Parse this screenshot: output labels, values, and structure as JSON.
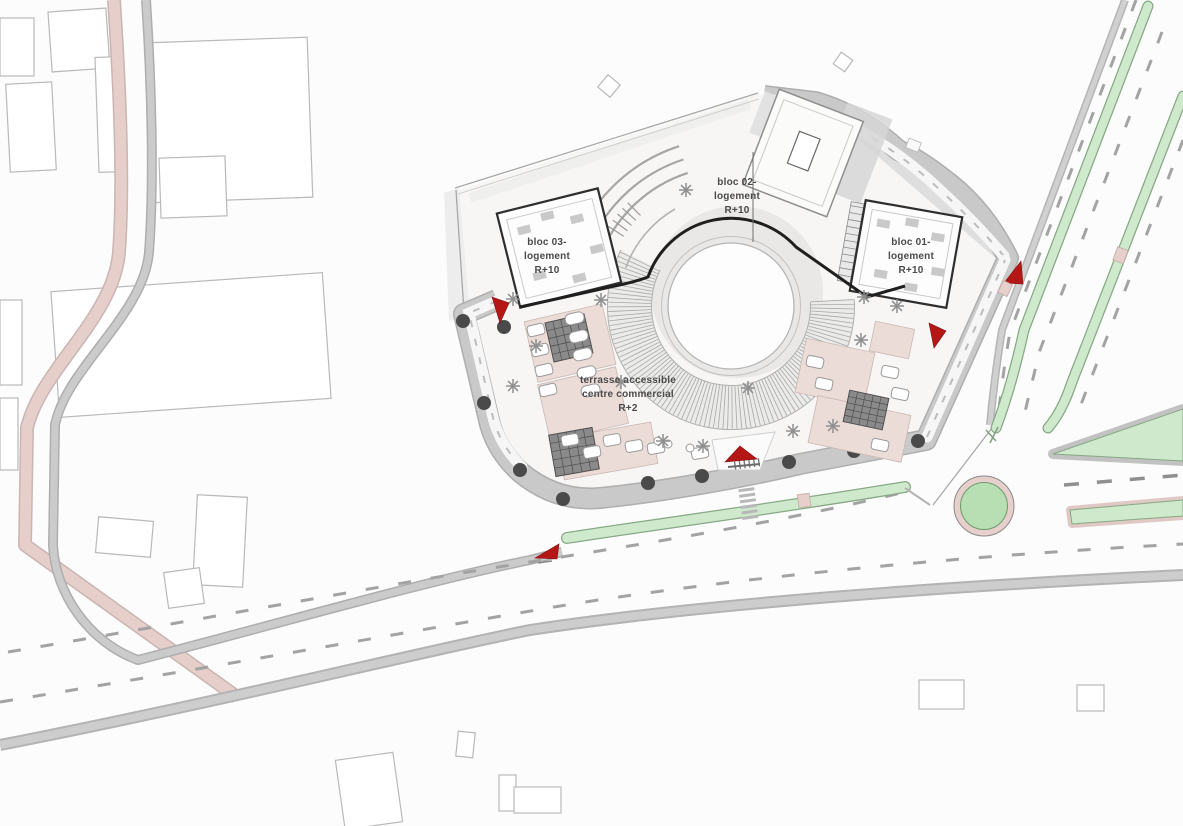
{
  "labels": {
    "bloc_03": [
      "bloc 03-",
      "logement",
      "R+10"
    ],
    "bloc_02": [
      "bloc 02-",
      "logement",
      "R+10"
    ],
    "bloc_01": [
      "bloc 01-",
      "logement",
      "R+10"
    ],
    "terrace": [
      "terrasse accessible",
      "centre commercial",
      "R+2"
    ]
  },
  "colors": {
    "background": "#fcfcfc",
    "context_building_stroke": "#b9b9b9",
    "road_band": "#c9c9c9",
    "road_band_edge": "#aeaeae",
    "road_casing": "#b5b5b5",
    "lane_dash": "#a3a3a3",
    "pink_path": "#e6cecb",
    "pink_path_edge": "#c9b5b2",
    "green_median": "#cfe9cd",
    "green_edge": "#86a884",
    "roundabout_ring": "#e7cfcb",
    "roundabout_green": "#b7dfb3",
    "terrace_pink": "#ecdcd8",
    "terrace_pink_edge": "#c9b7b3",
    "plot_fill": "#f7f6f5",
    "plaza_gray": "#e9e8e6",
    "annulus_fill": "#ebebe9",
    "hatch_line": "#a8a8a8",
    "heavy_outline": "#1f1f1f",
    "building_heavy": "#2e2e2e",
    "building_light": "#c9c9c9",
    "tree_dot": "#4a4a4a",
    "tree_glyph": "#8f8f8f",
    "access_arrow_red": "#b51717",
    "label_text": "#4a4a4a"
  }
}
